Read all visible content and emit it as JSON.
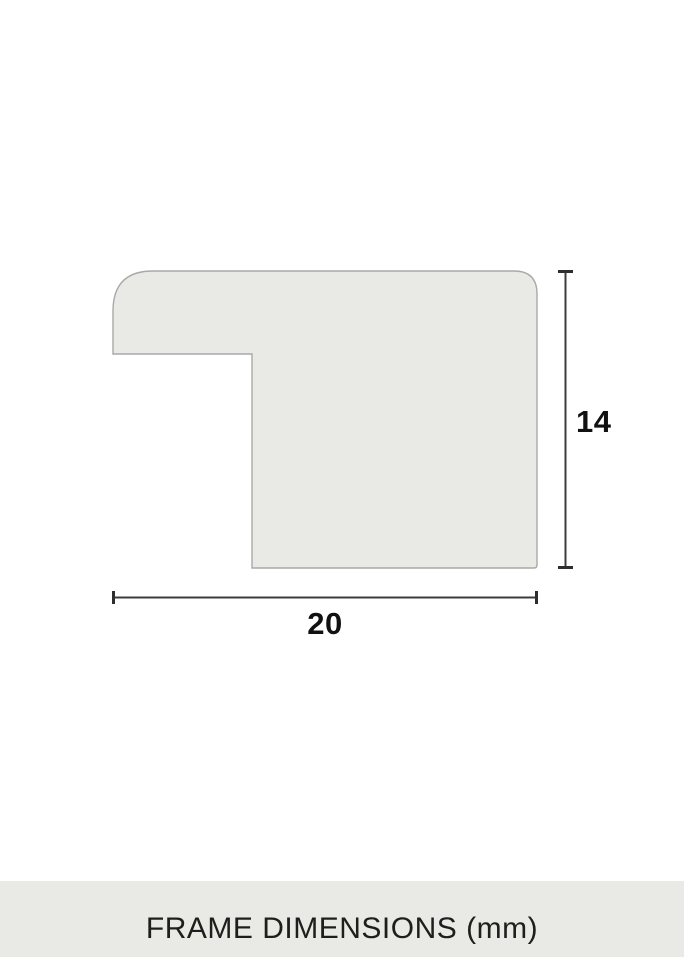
{
  "dimensions": {
    "height": {
      "label": "14"
    },
    "width": {
      "label": "20"
    }
  },
  "caption": {
    "label": "FRAME DIMENSIONS (mm)"
  },
  "colors": {
    "background": "#ffffff",
    "profile_fill": "#e9e9e5",
    "profile_stroke": "#a9a9a9",
    "dimension_line": "#3c3c3c",
    "dimension_tick": "#2e2e2e",
    "label_text": "#111111",
    "caption_bar_bg": "#e9e9e5",
    "caption_text": "#1e1e1e"
  }
}
